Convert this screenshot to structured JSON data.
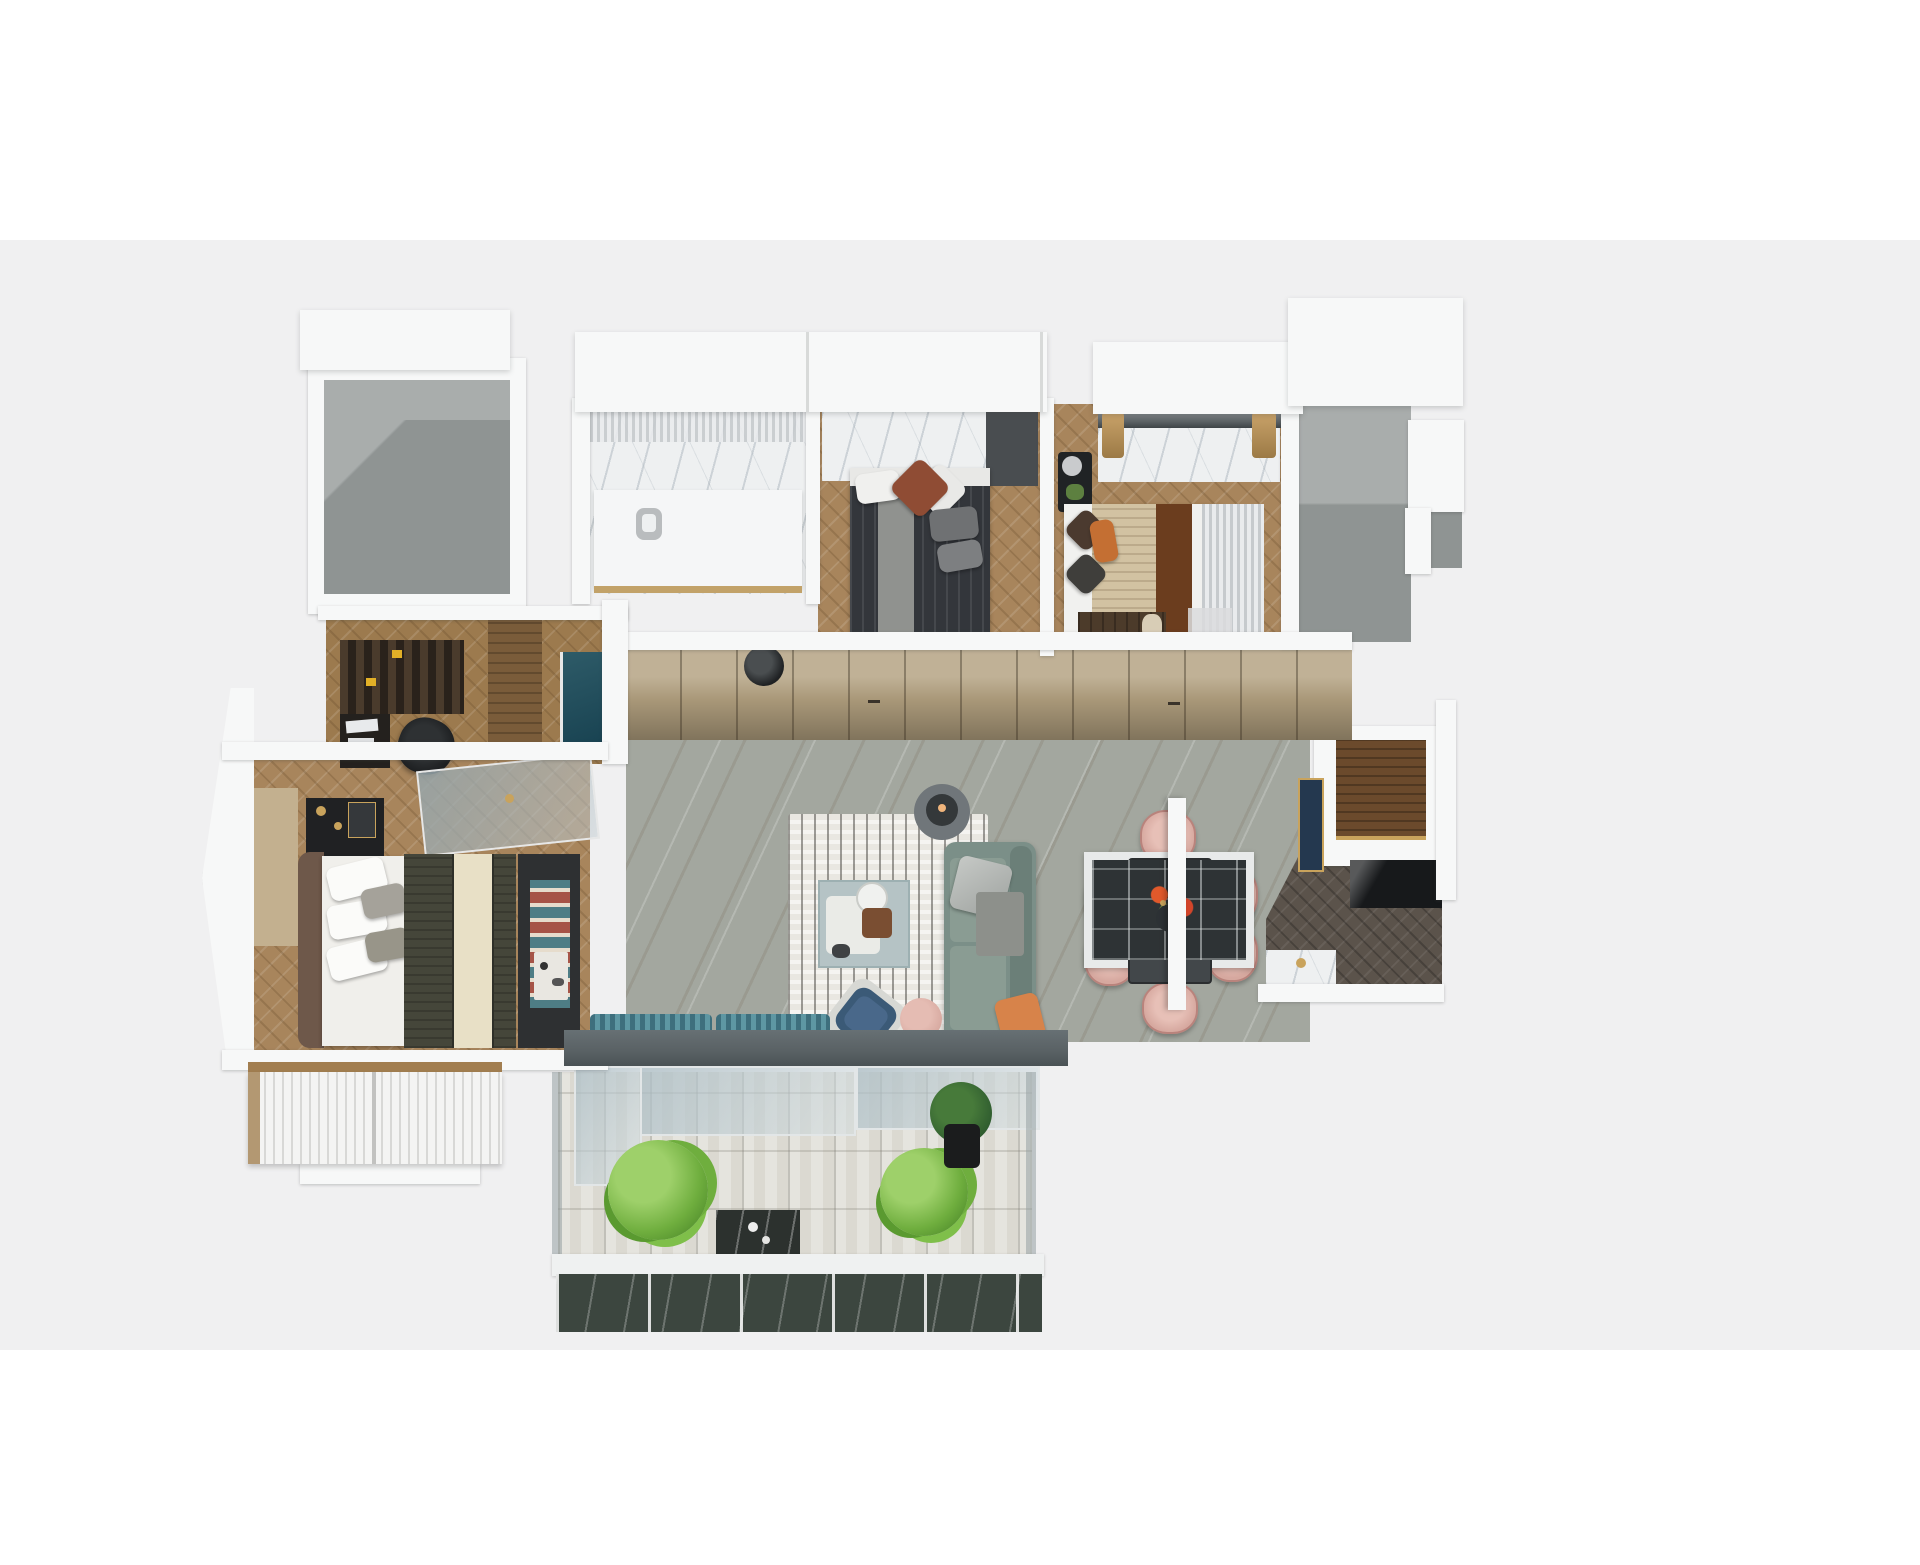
{
  "scene": {
    "title": "apartment-3d-floor-plan",
    "style": "isometric top-down architectural render, no text labels",
    "background": {
      "top_band": "#ffffff",
      "canvas": "#f0f0f1"
    },
    "rooms": [
      {
        "name": "utility-room",
        "floor": "gray-concrete",
        "items": []
      },
      {
        "name": "bathroom",
        "floor": "white-marble",
        "items": [
          "shower-curtain",
          "vanity-counter",
          "stool",
          "gold-threshold"
        ]
      },
      {
        "name": "bedroom-2",
        "floor": "herringbone-wood",
        "items": [
          "marble-headboard-wall",
          "dark-wardrobe-panel",
          "double-bed-dark",
          "gray-throw",
          "white-pillow",
          "rust-pillow"
        ]
      },
      {
        "name": "bedroom-3",
        "floor": "herringbone-wood",
        "items": [
          "window",
          "marble-desk",
          "wheat-tassels",
          "black-nightstand",
          "candle",
          "plant-pot",
          "double-bed-beige",
          "brown-runner",
          "curtains",
          "tv-cabinet",
          "vase"
        ]
      },
      {
        "name": "stairwell-zone",
        "floor": "gray",
        "items": [
          "stepped-walls"
        ]
      },
      {
        "name": "hallway",
        "floor": "gray-marble",
        "items": [
          "wardrobe-cabinets",
          "cabinet-handles"
        ]
      },
      {
        "name": "study",
        "floor": "herringbone-wood",
        "items": [
          "bookshelf",
          "yellow-books",
          "desk",
          "papers",
          "office-chair",
          "tall-cabinet",
          "teal-glass-door"
        ]
      },
      {
        "name": "master-bedroom",
        "floor": "herringbone-wood",
        "items": [
          "headboard-panel",
          "black-console",
          "gold-decor",
          "glass-desk",
          "double-bed",
          "white-pillows",
          "striped-duvet",
          "cream-runner",
          "bench",
          "zigzag-throw",
          "breakfast-tray",
          "louver-wardrobe"
        ]
      },
      {
        "name": "living-room",
        "floor": "gray-marble",
        "items": [
          "pendant-lamp",
          "striped-rug",
          "green-sofa",
          "silver-pillow",
          "orange-pillow",
          "gray-throw",
          "coffee-table",
          "tray",
          "teapot",
          "basket",
          "side-table",
          "table-lamp",
          "blue-armchair",
          "pink-pouf",
          "teal-bench",
          "teal-bench"
        ]
      },
      {
        "name": "dining-area",
        "floor": "gray-marble",
        "items": [
          "dining-table",
          "flower-centerpiece",
          "vase",
          "dining-chair",
          "dining-chair",
          "dining-chair",
          "dining-chair",
          "dining-chair",
          "dining-chair",
          "white-column"
        ]
      },
      {
        "name": "kitchen",
        "floor": "dark-herringbone-wood",
        "items": [
          "white-counter",
          "wood-countertop",
          "navy-cabinet-gold-trim",
          "black-base-cabinets",
          "marble-side-table",
          "gold-kettle"
        ]
      },
      {
        "name": "kitchen-balcony",
        "floor": "none",
        "items": [
          "glazed-window-grid"
        ]
      },
      {
        "name": "balcony",
        "floor": "pavers",
        "items": [
          "header-beam",
          "sliding-glass-doors",
          "fluffy-plant",
          "fluffy-plant",
          "potted-plant-dark",
          "marble-bench",
          "white-curb",
          "marble-parapet",
          "glass-side-rails"
        ]
      }
    ]
  },
  "palette": {
    "bg": "#f0f0f1",
    "white": "#ffffff",
    "wall": "#f7f8f8",
    "grayRoomLight": "#a9adac",
    "grayRoomDark": "#8f9493",
    "marble": "#eef0f1",
    "wood1": "#a8855c",
    "wood2": "#9c7a4e",
    "woodDark": "#6b4a2c",
    "wardrobeTan": "#b2a07f",
    "wardrobeTanDark": "#8a785a",
    "livingFloor": "#a3a79f",
    "rugBase": "#e9e7e1",
    "sofaGreen": "#7b8f88",
    "sofaGreenDark": "#6b7f78",
    "orange": "#d7834a",
    "chairPink": "#d6a89f",
    "chairPinkDark": "#b9837c",
    "tableDark": "#42474a",
    "flowersOrange": "#e0592b",
    "navy": "#24384f",
    "gold": "#c9a35c",
    "kitchenFloor": "#5b534b",
    "black": "#17191b",
    "beam": "#596164",
    "paver": "#dbd9d1",
    "plantGreen": "#6fae3e",
    "plantLight": "#9ed06a",
    "plantDark": "#2f5c2f",
    "teal": "#3e6f7d",
    "tealLight": "#5e97a3",
    "duvetOlive": "#45463a",
    "cream": "#e8e0c6",
    "zigzagTeal": "#4e7d85",
    "zigzagRed": "#a65447",
    "bed2Dark": "#33363b",
    "panelGray": "#494d50",
    "knitBeige": "#d2c2a2",
    "runnerBrown": "#6b3d1e",
    "curtain": "#c6cacd",
    "shelfDark": "#30271f",
    "bookYellow": "#e2b027",
    "glassTeal": "#2e5b68",
    "headboardTan": "#c3b08f",
    "benchDark": "#2e3032",
    "pouf": "#d7a9a0",
    "armchairBlue": "#3b5a77",
    "blueFrame": "#d7d8d4",
    "marbleDark": "#3c463f"
  }
}
